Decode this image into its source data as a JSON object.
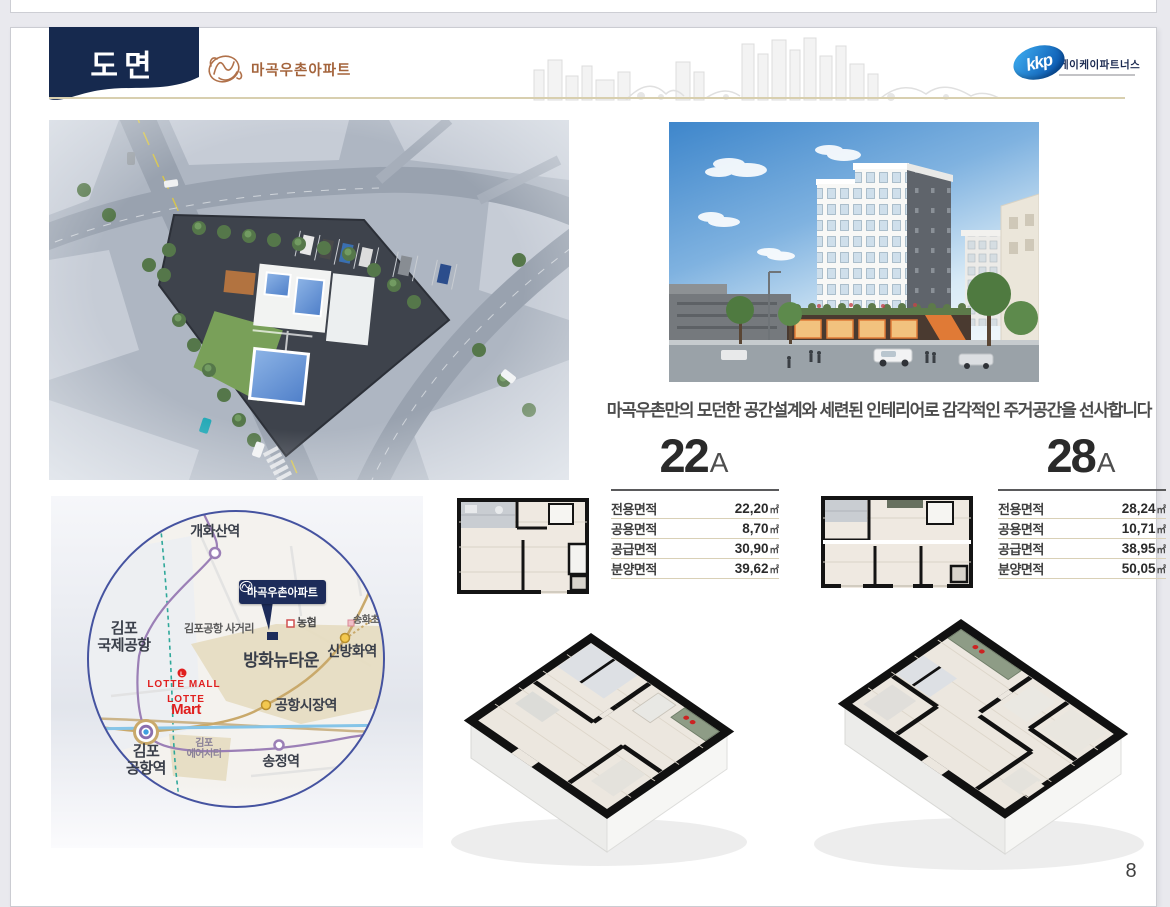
{
  "header": {
    "title": "도면",
    "brand": "마곡우촌아파트",
    "partner": {
      "logo_text": "kkp",
      "name": "케이케이파트너스"
    }
  },
  "description": "마곡우촌만의 모던한 공간설계와 세련된 인테리어로 감각적인 주거공간을 선사합니다",
  "units": [
    {
      "size": "22",
      "type": "A",
      "areas": [
        {
          "label": "전용면적",
          "value": "22,20",
          "unit": "㎡"
        },
        {
          "label": "공용면적",
          "value": "8,70",
          "unit": "㎡"
        },
        {
          "label": "공급면적",
          "value": "30,90",
          "unit": "㎡"
        },
        {
          "label": "분양면적",
          "value": "39,62",
          "unit": "㎡"
        }
      ]
    },
    {
      "size": "28",
      "type": "A",
      "areas": [
        {
          "label": "전용면적",
          "value": "28,24",
          "unit": "㎡"
        },
        {
          "label": "공용면적",
          "value": "10,71",
          "unit": "㎡"
        },
        {
          "label": "공급면적",
          "value": "38,95",
          "unit": "㎡"
        },
        {
          "label": "분양면적",
          "value": "50,05",
          "unit": "㎡"
        }
      ]
    }
  ],
  "map": {
    "callout": "마곡우촌아파트",
    "labels": {
      "gaehwasan": "개화산역",
      "sinbanghwa": "신방화역",
      "gonghang_sijang": "공항시장역",
      "songjeong": "송정역",
      "gimpo_airport_station": "김포\n공항역",
      "gimpo_intl_airport": "김포\n국제공항",
      "gimpo_junction": "김포공항 사거리",
      "banghwa_newtown": "방화뉴타운",
      "gimpo_aircity": "김포\n에어시티",
      "lotte_mall": "LOTTE MALL",
      "lotte": "LOTTE",
      "mart": "Mart",
      "nonghyup": "농협",
      "songhwa": "송화초"
    }
  },
  "page_number": "8",
  "colors": {
    "navy": "#16294e",
    "copper": "#a4643c",
    "kkp_blue": "#0a57b0",
    "tan_line": "#d8cfaf",
    "map_ring": "#4553a0"
  }
}
